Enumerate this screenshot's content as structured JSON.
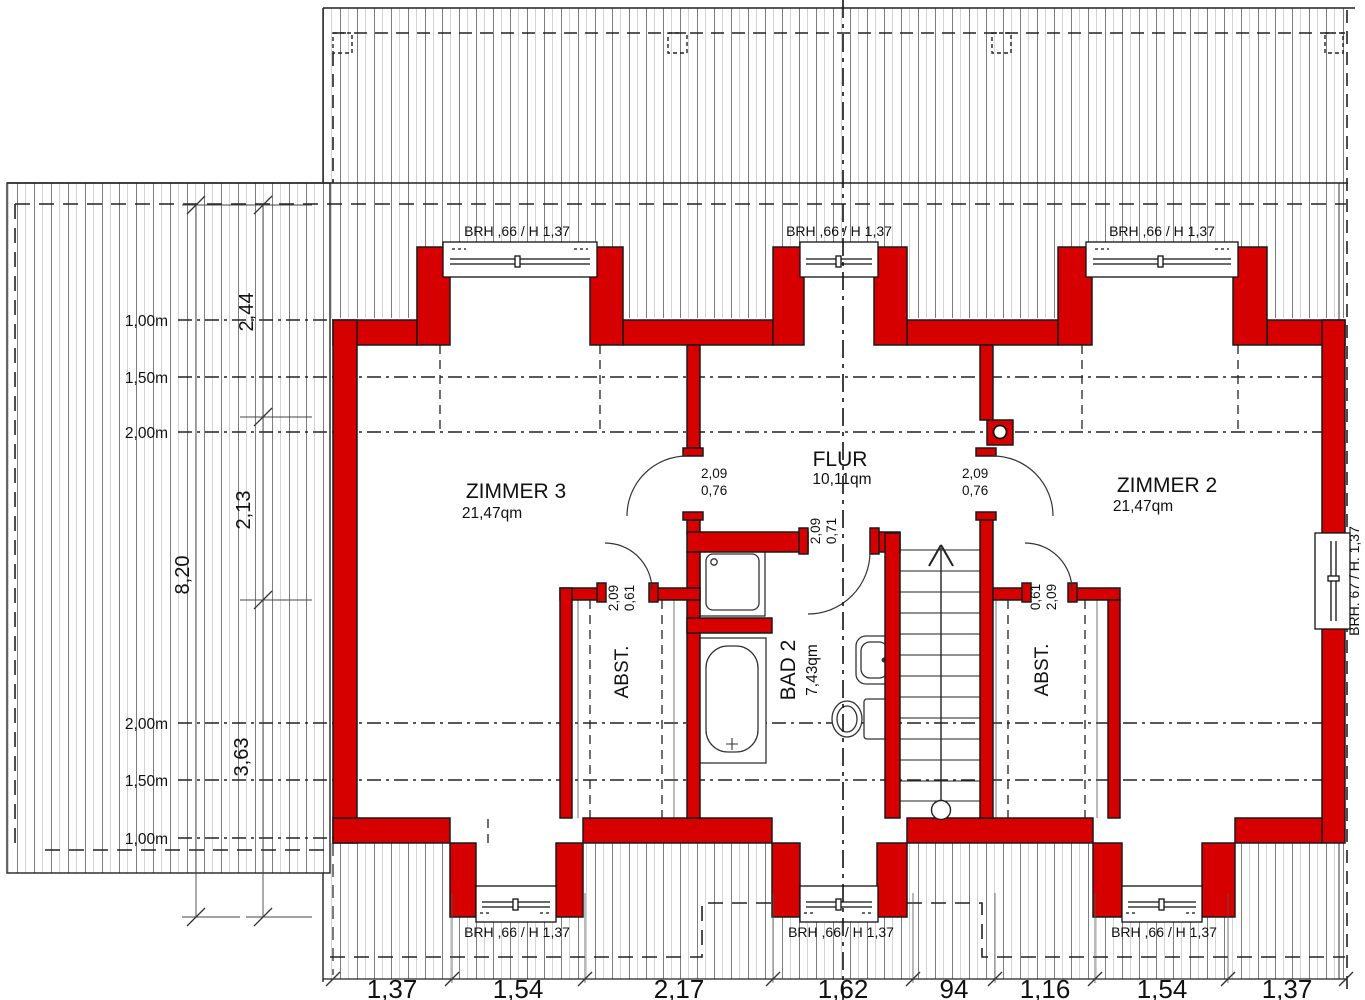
{
  "rooms": {
    "zimmer3": {
      "name": "ZIMMER 3",
      "area": "21,47qm"
    },
    "zimmer2": {
      "name": "ZIMMER 2",
      "area": "21,47qm"
    },
    "flur": {
      "name": "FLUR",
      "area": "10,11qm"
    },
    "bad2": {
      "name": "BAD 2",
      "area": "7,43qm"
    },
    "abst_left": {
      "name": "ABST."
    },
    "abst_right": {
      "name": "ABST."
    }
  },
  "window_labels": {
    "top": [
      "BRH ,66 / H 1,37",
      "BRH ,66 / H 1,37",
      "BRH ,66 / H 1,37"
    ],
    "bottom": [
      "BRH ,66 / H 1,37",
      "BRH ,66 / H 1,37",
      "BRH ,66 / H 1,37"
    ],
    "right": "BRH. 67 / H. 1,37"
  },
  "door_labels": {
    "flur_left": {
      "height": "2,09",
      "width": "0,76"
    },
    "flur_right": {
      "height": "2,09",
      "width": "0,76"
    },
    "bad": {
      "height": "2,09",
      "width": "0,71"
    },
    "abst_left": {
      "height": "2,09",
      "width": "0,61"
    },
    "abst_right": {
      "width": "0,61",
      "height": "2,09"
    }
  },
  "roof_height_contours": {
    "upper": [
      "1,00m",
      "1,50m",
      "2,00m"
    ],
    "lower": [
      "2,00m",
      "1,50m",
      "1,00m"
    ]
  },
  "dimensions": {
    "left_total": "8,20",
    "left_segments": [
      "2,44",
      "2,13",
      "3,63"
    ],
    "bottom_chain": [
      "1,37",
      "1,54",
      "2,17",
      "1,62",
      "94",
      "1,16",
      "1,54",
      "1,37"
    ]
  },
  "colors": {
    "wall": "#d60000",
    "outline": "#1a1a1a",
    "hatch": "#8a8a8a"
  }
}
